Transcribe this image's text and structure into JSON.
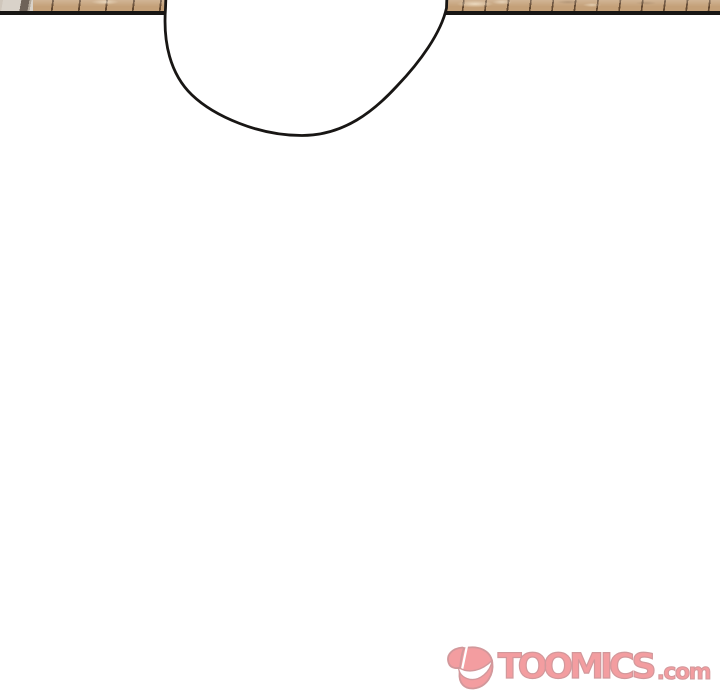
{
  "colors": {
    "page-bg": "#ffffff",
    "ink": "#181614",
    "panel-border": "#181614",
    "wood": "#c4a078",
    "wall-light": "#cfc6bb",
    "wall-lighter": "#d9d2c9",
    "wall-mid": "#b4a99b",
    "wall-dark": "#6e6258",
    "logo-pink": "#f29599",
    "logo-outline": "#cf9093"
  },
  "watermark": {
    "brand": "TOOMICS",
    "suffix": ".com",
    "icon": "toomics-smile-icon"
  }
}
